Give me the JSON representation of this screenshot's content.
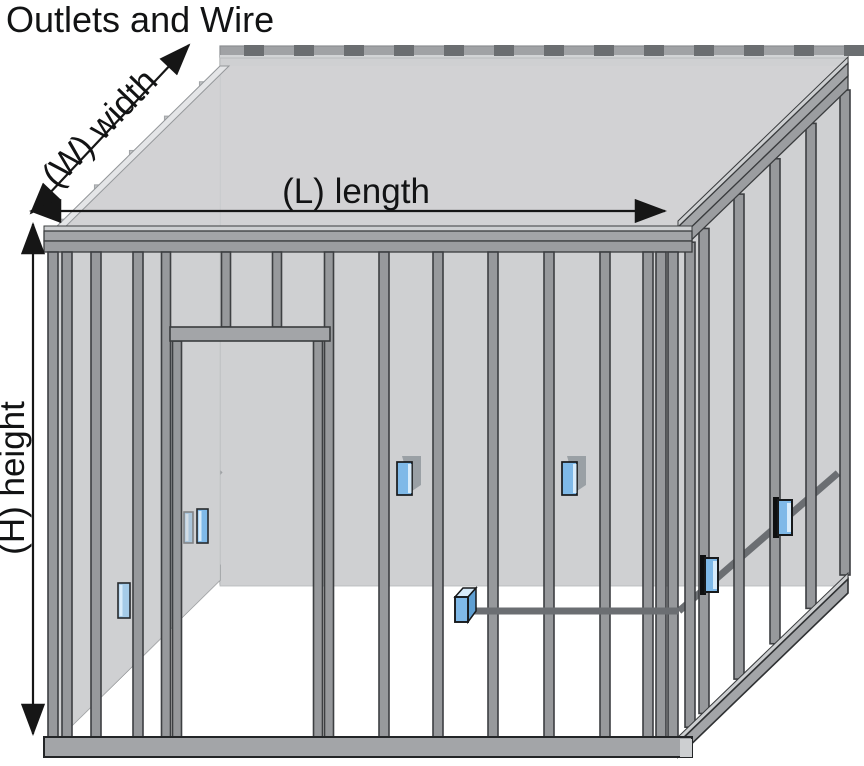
{
  "title": "Outlets and Wire",
  "labels": {
    "width": "(W) width",
    "length": "(L) length",
    "height": "(H) height"
  },
  "colors": {
    "background": "#ffffff",
    "text": "#121314",
    "arrow": "#161616",
    "stud": "#97999c",
    "stud_outline": "#3d3f42",
    "plate": "#a3a5a8",
    "plate_light": "#cdcfd1",
    "plate_outline": "#3a3c3e",
    "muted_stud": "#c4c6c8",
    "muted_stud_outline": "#a3a6a9",
    "muted_plate": "#a0a2a5",
    "muted_outline": "#8b8e91",
    "panel": "#cfd0d2",
    "ceiling_panel": "#d4d5d7",
    "panel_edge": "#e4e5e7",
    "wire": "#6b6e72",
    "wire_muted": "#9ea1a4",
    "outlet_blue": "#7fb9e8",
    "outlet_blue_light": "#d7ebfa",
    "outlet_blue_mid": "#5f9fd2",
    "outlet_blue_muted": "#a5cbe8",
    "outlet_outline": "#17191b",
    "joist": "#6b6e71"
  },
  "outlets": [
    {
      "id": "left-wall-outlet-1",
      "wall": "left",
      "x": 118,
      "y": 583,
      "w": 12,
      "h": 35,
      "variant": "flat-muted"
    },
    {
      "id": "left-wall-outlet-2",
      "wall": "left",
      "x": 184,
      "y": 512,
      "w": 9,
      "h": 31,
      "variant": "flat-faint"
    },
    {
      "id": "left-wall-outlet-3",
      "wall": "left",
      "x": 197,
      "y": 509,
      "w": 11,
      "h": 34,
      "variant": "flat"
    },
    {
      "id": "back-wall-outlet-1",
      "wall": "back",
      "x": 397,
      "y": 462,
      "w": 15,
      "h": 33,
      "variant": "box-back"
    },
    {
      "id": "back-wall-outlet-2",
      "wall": "back",
      "x": 562,
      "y": 462,
      "w": 15,
      "h": 33,
      "variant": "box-back"
    },
    {
      "id": "front-wall-outlet",
      "wall": "front",
      "x": 455,
      "y": 597,
      "w": 13,
      "h": 25,
      "variant": "box-front"
    },
    {
      "id": "right-wall-outlet-1",
      "wall": "right",
      "x": 705,
      "y": 558,
      "w": 13,
      "h": 34,
      "variant": "bracket"
    },
    {
      "id": "right-wall-outlet-2",
      "wall": "right",
      "x": 778,
      "y": 500,
      "w": 14,
      "h": 35,
      "variant": "bracket"
    }
  ],
  "wires": [
    {
      "id": "back-wall-wire",
      "muted": true,
      "points": [
        [
          220,
          470
        ],
        [
          848,
          470
        ]
      ]
    },
    {
      "id": "left-wall-wire",
      "muted": true,
      "points": [
        [
          58,
          626
        ],
        [
          118,
          590
        ],
        [
          150,
          566
        ],
        [
          186,
          508
        ],
        [
          220,
          470
        ]
      ]
    },
    {
      "id": "right-wall-wire",
      "muted": false,
      "points": [
        [
          679,
          611
        ],
        [
          838,
          473
        ]
      ]
    },
    {
      "id": "front-wall-wire",
      "muted": false,
      "points": [
        [
          470,
          611
        ],
        [
          679,
          611
        ]
      ]
    }
  ]
}
